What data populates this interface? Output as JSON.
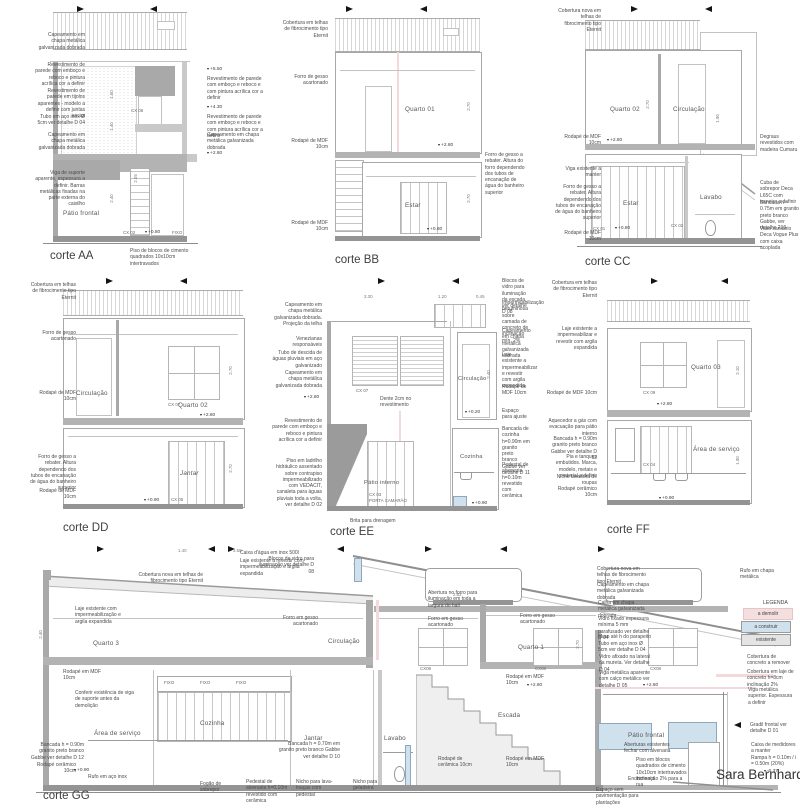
{
  "project": {
    "title": "Sara Bernhardt"
  },
  "legend": {
    "title": "LEGENDA",
    "items": [
      {
        "label": "a demolir",
        "color": "#f5dede"
      },
      {
        "label": "a construir",
        "color": "#cfe1ed"
      },
      {
        "label": "existente",
        "color": "#e4e4e4"
      }
    ]
  },
  "sections": {
    "aa": {
      "title": "corte AA",
      "room_patio": "Pátio frontal",
      "left": [
        "Capeamento em chapa metálica galvanizada dobrada",
        "Revestimento de parede com emboço e reboco e pintura acrílica cor a definir",
        "Revestimento de parede em tijolos aparentes - modelo a definir com juntas secas",
        "Tubo em aço inox Ø 5cm ver detalhe D 04",
        "Capeamento em chapa metálica galvanizada dobrada",
        "Viga de suporte aparente, espessura a definir. Barras metálicas fixadas na parte externa do caixilho"
      ],
      "right": [
        "+5.50",
        "Revestimento de parede com emboço e reboco e com pintura acrílica cor a definir",
        "+4.30",
        "Revestimento de parede com emboço e reboco e com pintura acrílica cor a definir",
        "Capeamento em chapa metálica galvanizada dobrada",
        "+2.80"
      ],
      "bottom": "Piso de blocos de cimento quadrados 10x10cm intertravados",
      "marks": [
        "CX 06",
        "CX 02",
        "FIXO",
        "+0.80"
      ],
      "dims": [
        "1.50",
        "1.40",
        "2.40",
        "2.05"
      ]
    },
    "bb": {
      "title": "corte BB",
      "rooms": {
        "quarto": "Quarto 01",
        "estar": "Estar"
      },
      "left": [
        "Cobertura em telhas de fibrocimento tipo Eternit",
        "Forro de gesso acartonado",
        "Rodapé de MDF 10cm",
        "Rodapé de MDF 10cm"
      ],
      "right": [
        "Forro de gesso a rebater. Altura do forro dependendo dos tubos de encanação de água do banheiro superior"
      ],
      "elev": [
        "+2.80",
        "+0.80"
      ],
      "dims": [
        "2.70",
        "2.70"
      ]
    },
    "cc": {
      "title": "corte CC",
      "rooms": {
        "quarto": "Quarto 02",
        "circ": "Circulação",
        "estar": "Estar",
        "lavabo": "Lavabo"
      },
      "left": [
        "Cobertura nova em telhas de fibrocimento tipo Eternit",
        "Rodapé de MDF 10cm",
        "Viga existente a manter",
        "Forro de gesso a rebater. Altura dependendo dos tubos de encanação de água do banheiro superior",
        "Rodapé de MDF 10cm"
      ],
      "right": [
        "Degraus revestidos com madeira Cumaru",
        "Cuba de sobrepor Deca L65C com torneira a definir",
        "Bancada h = 0.75m em granito preto branco Gabbe, ver detalhe 210",
        "Vaso sanitário Deca Vogue Plus com caixa acoplada"
      ],
      "elev": [
        "+2.80",
        "+0.80"
      ],
      "marks": [
        "CX 01",
        "CX 02"
      ],
      "dims": [
        "2.70",
        "1.90"
      ]
    },
    "dd": {
      "title": "corte DD",
      "rooms": {
        "circ": "Circulação",
        "quarto": "Quarto 02",
        "jantar": "Jantar"
      },
      "left": [
        "Cobertura em telhas de fibrocimento tipo Eternit",
        "Forro de gesso acartonado",
        "Rodapé de MDF 10cm",
        "Forro de gesso a rebater. Altura dependendo dos tubos de encanação de água do banheiro superior",
        "Rodapé de MDF 10cm"
      ],
      "elev": [
        "+2.80",
        "+0.90"
      ],
      "marks": [
        "CX 07",
        "CX 05"
      ],
      "dims": [
        "2.70",
        "2.70"
      ]
    },
    "ee": {
      "title": "corte EE",
      "rooms": {
        "circ": "Circulação",
        "patio": "Pátio interno",
        "coz": "Cozinha"
      },
      "left": [
        "Capeamento em chapa metálica galvanizada dobrada. Projeção da telha",
        "Venezianas responsáveis",
        "Tubo de descida de águas pluviais em aço galvanizado",
        "Capeamento em chapa metálica galvanizada dobrada",
        "+2.80",
        "Revestimento de parede com emboço e reboco e pintura acrílica cor a definir",
        "Piso em ladrilho hidráulico assentado sobre contrapiso impermeabilizado com VEDACIT, canaleta para águas pluviais toda a volta, ver detalhe D 02"
      ],
      "right": [
        "Blocos de vidro para iluminação da escada ver detalhe D 08",
        "Impermeabilização betuminosa sobre camada de concreto de inclinação mín. 2%",
        "Capeamento em chapa metálica galvanizada dobrada",
        "Laje existente a impermeabilizar e revestir com argila expandida",
        "Rodapé de MDF 10cm",
        "Espaço para ajuste",
        "Bancada de cozinha h=0.90m em granito preto branco Gabbe ver detalhe D 11",
        "Pedestal de alvenaria h=0.10m revestido com cerâmica"
      ],
      "notes": [
        "Dente 2cm no revestimento",
        "Brita para drenagem"
      ],
      "marks": [
        "CX 07",
        "CX 03",
        "PORTA CAMARÃO"
      ],
      "elev": [
        "+0.20",
        "+0.90"
      ],
      "dims": [
        "3.30",
        "1.20",
        "0.45",
        "2.40"
      ]
    },
    "ff": {
      "title": "corte FF",
      "rooms": {
        "quarto": "Quarto 03",
        "servico": "Área de serviço"
      },
      "left": [
        "Cobertura em telhas de fibrocimento tipo Eternit",
        "Laje existente a impermeabilizar e revestir com argila expandida",
        "Rodapé de MDF 10cm",
        "Aquecedor a gás com evacuação para pátio interno",
        "Bancada h = 0.90m granito preto branco Gabbe ver detalhe D 12",
        "Pia e tanques embutidos. Marca, modelo, metais e material a definir",
        "Nicho lavadora de roupas",
        "Rodapé cerâmico 10cm"
      ],
      "marks": [
        "CX 09",
        "CX 04"
      ],
      "elev": [
        "+2.80",
        "+0.90"
      ],
      "dims": [
        "2.10",
        "1.90"
      ]
    },
    "gg": {
      "title": "corte GG",
      "rooms": [
        "Quarto 3",
        "Circulação",
        "Quarto 1",
        "Área de serviço",
        "Cozinha",
        "Jantar",
        "Lavabo",
        "Escada",
        "Pátio frontal"
      ],
      "top": [
        "Caixa d'água em inox 500l",
        "Laje existente a revestir com impermeabilização e argila expandida",
        "Cobertura nova em telhas de fibrocimento tipo Eternit",
        "Blocos de vidro para iluminação ver detalhe D 08",
        "Abertura no forro para iluminação em toda a largura do hall",
        "Rufo em chapa metálica"
      ],
      "left": [
        "Laje existente com impermeabilização e argila expandida",
        "Rodapé em MDF 10cm",
        "Conferir existência de viga de suporte antes da demolição",
        "Bancada h = 0.90m granito preto branco Gabbe ver detalhe D 12",
        "Rodapé cerâmico 10cm",
        "Rufo em aço inox"
      ],
      "mid": [
        "Forro em gesso acartonado",
        "Forro em gesso acartonado",
        "Forro em gesso acartonado",
        "Rodapé em MDF 10cm",
        "Bancada h = 0.70m em granito preto branco Gabbe ver detalhe D 10",
        "Rodapé de cerâmica 10cm",
        "Rodapé em MDF 10cm"
      ],
      "bottom": [
        "Fogão de sobrepor",
        "Pedestal de alvenaria h=0.10m revestido com cerâmica",
        "Nicho para lava-louças com pedestal",
        "Nicho para geladeira",
        "Enchimento",
        "Espaço sem pavimentação para plantações"
      ],
      "right": [
        "Cobertura nova em telhas de fibrocimento tipo Eternit",
        "Capeamento em chapa metálica galvanizada dobrada",
        "Calha em chapa metálica galvanizada dobrada",
        "Vidro fixado espessura mínima 5 mm parafusado ver detalhe D 04",
        "Muro até h do parapeito",
        "Tubo em aço inox Ø 5cm ver detalhe D 04",
        "Vidro afixado na lateral da mureta. Ver detalhe D 04",
        "Viga metálica aparente com calço metálico ver detalhe D 05"
      ],
      "far_right": [
        "Cobertura de concreto a remover",
        "Cobertura em laje de concreto h=8cm inclinação 2%",
        "Viga metálica superior. Espessura a definir",
        "Gradil frontal ver detalhe D 01",
        "Caixa de medidores a manter",
        "Rampa h = 0.10m / i = 0.50m (20%)"
      ],
      "patio": [
        "Aberturas existentes fechar com alvenaria",
        "Piso em blocos quadrados de cimento 10x10cm intertravados inclinação 2% para a rua"
      ],
      "marks": [
        "CX08",
        "FIXO"
      ],
      "elev": [
        "+2.80",
        "+0.90",
        "-0.37"
      ],
      "dims": [
        "1.40",
        "3.58",
        "2.62",
        "2.40",
        "2.70"
      ]
    }
  }
}
